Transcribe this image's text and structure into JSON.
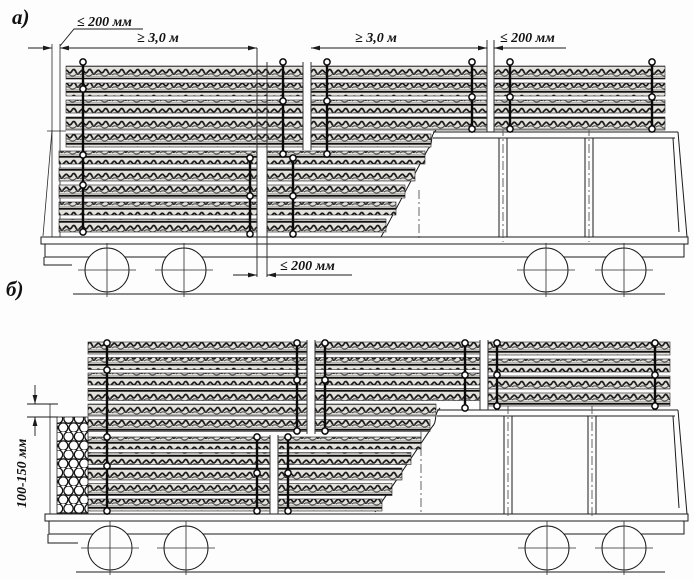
{
  "figure": {
    "labels": {
      "a": "а)",
      "b": "б)"
    },
    "dimensions": {
      "a_left_gap": "≤ 200 мм",
      "a_span_1": "≥ 3,0 м",
      "a_span_2": "≥ 3,0 м",
      "a_right_gap": "≤ 200 мм",
      "a_bottom_gap": "≤ 200 мм",
      "b_height_offset": "100-150 мм"
    },
    "colors": {
      "background": "#ffffff",
      "line": "#1a1a1a"
    }
  }
}
